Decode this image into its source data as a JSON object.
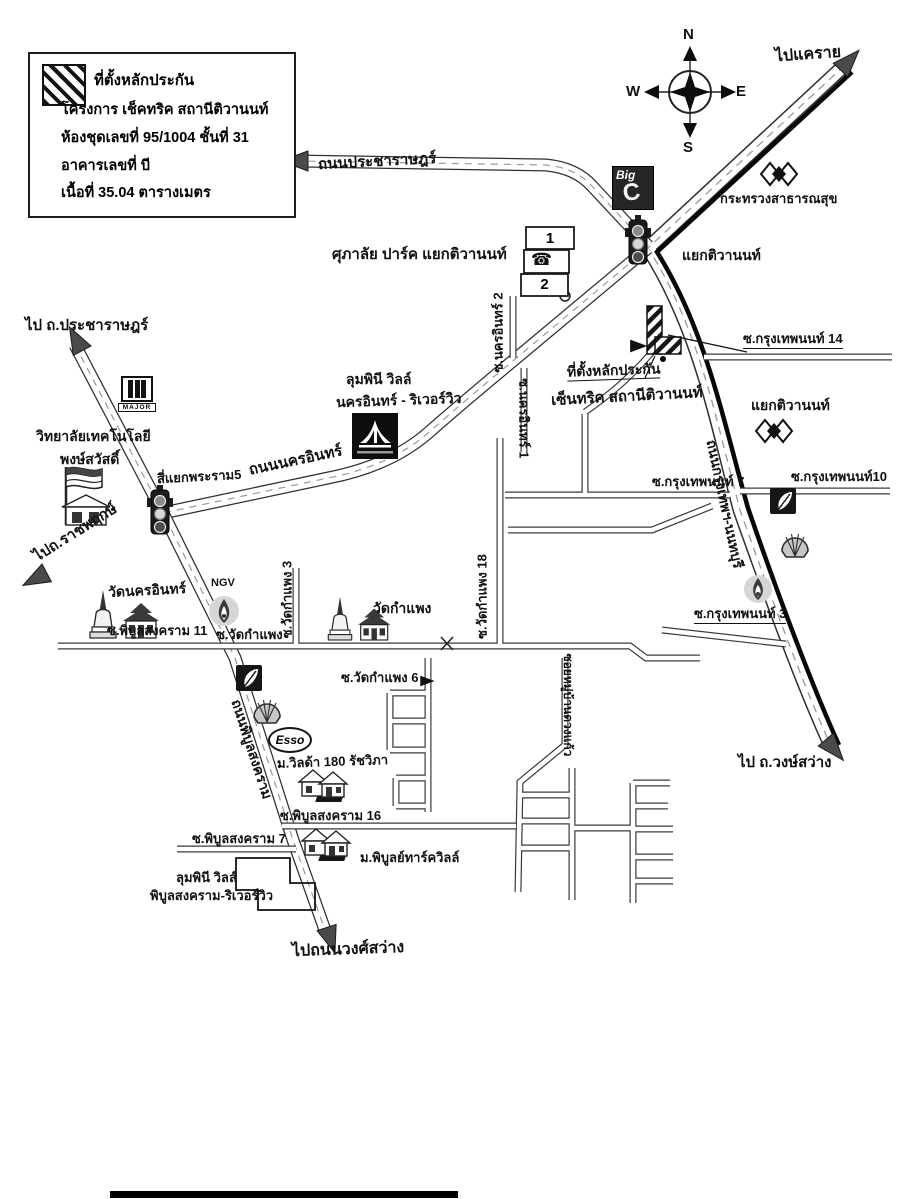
{
  "legend": {
    "line1": "ที่ตั้งหลักประกัน",
    "line2": "โครงการ เช็คทริค สถานีติวานนท์",
    "line3": "ห้องชุดเลขที่ 95/1004 ชั้นที่ 31",
    "line4": "อาคารเลขที่ บี",
    "line5": "เนื้อที่ 35.04 ตารางเมตร"
  },
  "compass": {
    "n": "N",
    "w": "W",
    "e": "E",
    "s": "S"
  },
  "destinations": {
    "khae_rai": "ไปแคราย",
    "pracharat": "ไป ถ.ประชาราษฎร์",
    "ratchaphruek": "ไปถ.ราชพฤกษ์",
    "wong_sawang": "ไป ถ.วงษ์สว่าง",
    "wong_sawang_road": "ไปถนนวงศ์สว่าง"
  },
  "roads": {
    "pracharat": "ถนนประชาราษฎร์",
    "nakhon_in": "ถนนนครอินทร์",
    "krungthep_non": "ถนนกรุงเทพฯ-นนทบุรี",
    "phibun": "ถนนพิบูลสงคราม"
  },
  "sois": {
    "nakhon_in_2": "ซ.นครอินทร์ 2",
    "nakhon_in_1": "ซ.นครอินทร์ 1",
    "ktn14": "ซ.กรุงเทพนนท์ 14",
    "ktn10": "ซ.กรุงเทพนนท์10",
    "ktn7": "ซ.กรุงเทพนนท์ 7",
    "ktn3": "ซ.กรุงเทพนนท์ 3",
    "pbs11": "ซ.พิบูลสงคราม 11",
    "pbs16": "ซ.พิบูลสงคราม 16",
    "pbs7": "ซ.พิบูลสงคราม 7",
    "wat_kamphaeng": "ซ.วัดกำแพง",
    "wk3": "ซ.วัดกำแพง 3",
    "wk18": "ซ.วัดกำแพง 18",
    "wk6": "ซ.วัดกำแพง 6",
    "muban": "ซอยหมู่บ้านดวงแก้ว"
  },
  "places": {
    "supalai": "ศุภาลัย ปาร์ค แยกติวานนท์",
    "yaek1": "แยกติวานนท์",
    "yaek2": "แยกติวานนท์",
    "ministry": "กระทรวงสาธารณสุข",
    "rama5": "สี่แยกพระราม5",
    "prop1": "ที่ตั้งหลักประกัน",
    "prop2": "เซ็นทริค สถานีติวานนท์",
    "lumpini_ni1": "ลุมพินี วิลล์",
    "lumpini_ni2": "นครอินทร์ - ริเวอร์วิว",
    "college1": "วิทยาลัยเทคโนโลยี",
    "college2": "พงษ์สวัสดิ์",
    "wat_nakhon_in": "วัดนครอินทร์",
    "wat_kamphaeng": "วัดกำแพง",
    "villa180": "ม.วิลด้า 180 รัชวิภา",
    "phibun_ville": "ม.พิบูลย์ทาร์ควิลล์",
    "lumpini_pb1": "ลุมพินี วิลล์",
    "lumpini_pb2": "พิบูลสงคราม-ริเวอร์วิว",
    "b1": "1",
    "b2": "2"
  },
  "logos": {
    "big": "Big",
    "big_c": "C",
    "major": "MAJOR",
    "esso": "Esso",
    "ngv": "NGV",
    "phone": "☎"
  },
  "colors": {
    "ink": "#1a1a1a",
    "paper": "#ffffff",
    "road_edge": "#2f2f2f"
  }
}
